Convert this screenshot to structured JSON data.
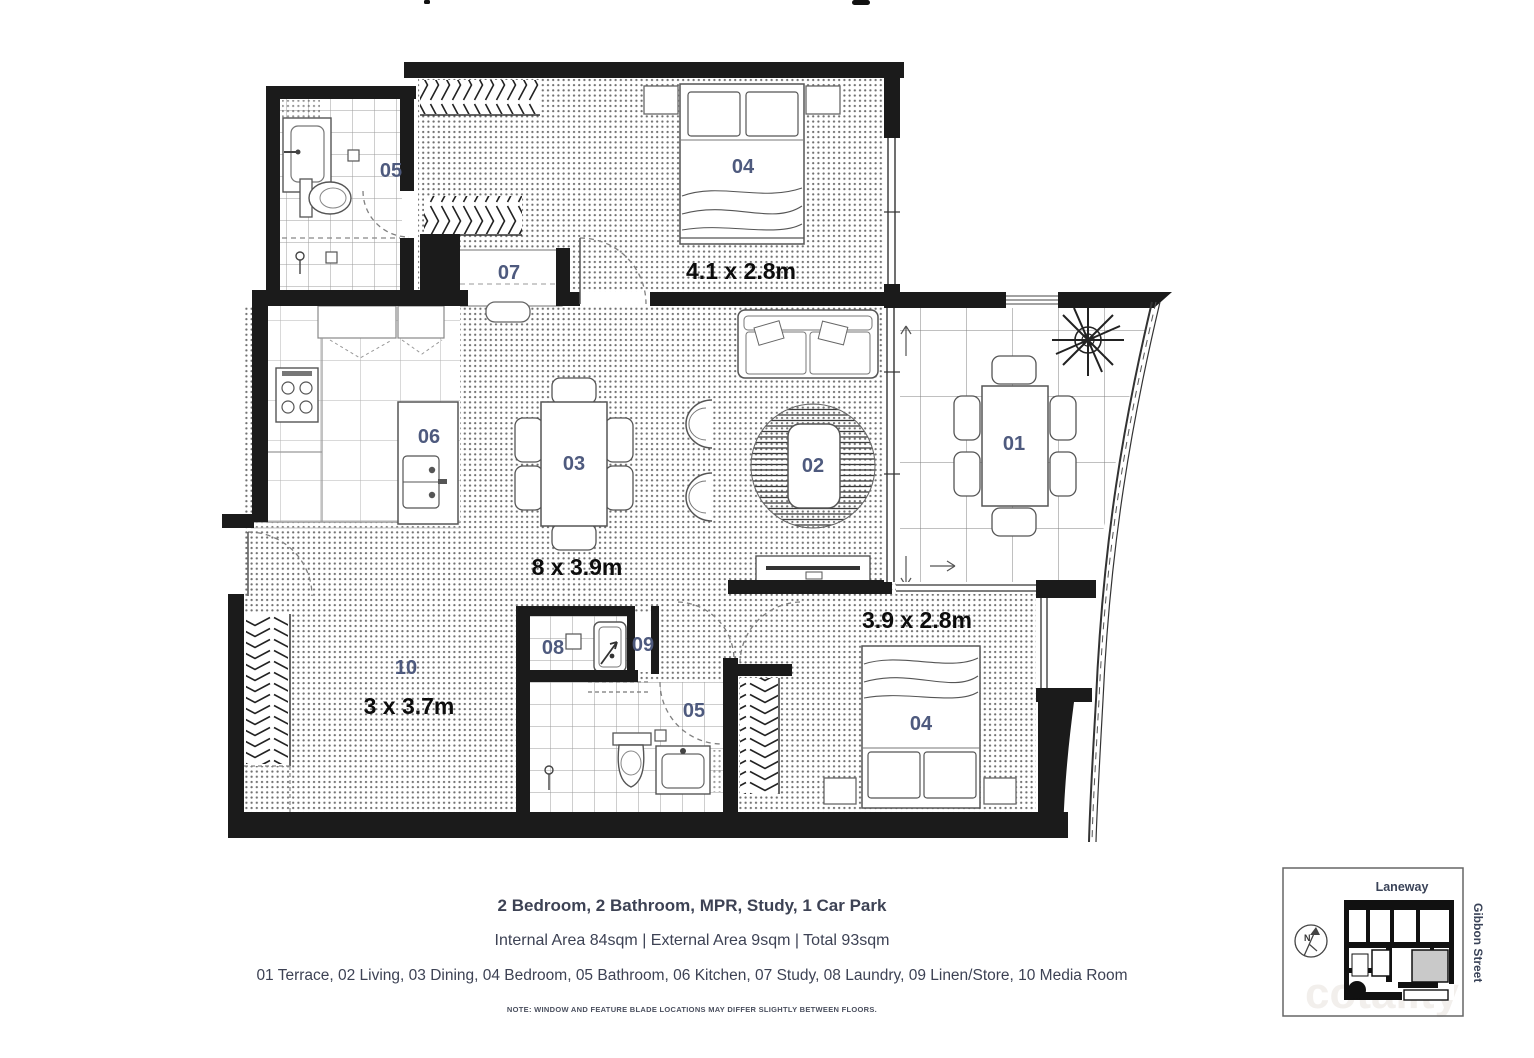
{
  "plan": {
    "labels": {
      "terrace": "01",
      "living": "02",
      "dining": "03",
      "bedroom": "04",
      "bathroom": "05",
      "kitchen": "06",
      "study": "07",
      "laundry": "08",
      "linen": "09",
      "media": "10"
    },
    "dimensions": {
      "bedroom1": "4.1 x 2.8m",
      "living_dining": "8 x 3.9m",
      "bedroom2": "3.9 x 2.8m",
      "media": "3 x 3.7m"
    },
    "colors": {
      "wall": "#1b1b1b",
      "room_label": "#4e5a7e",
      "dimension": "#0d0d0d",
      "footer_text": "#3d4254"
    }
  },
  "footer": {
    "line1": "2 Bedroom, 2 Bathroom, MPR, Study, 1 Car Park",
    "line2": "Internal Area 84sqm  |  External Area 9sqm  |  Total 93sqm",
    "legend": "01 Terrace,  02 Living, 03 Dining, 04 Bedroom, 05 Bathroom, 06 Kitchen, 07 Study, 08 Laundry, 09 Linen/Store, 10 Media Room",
    "note": "NOTE: WINDOW AND FEATURE BLADE LOCATIONS MAY DIFFER SLIGHTLY BETWEEN FLOORS."
  },
  "locator": {
    "laneway_label": "Laneway",
    "street_label": "Gibbon Street",
    "north_label": "N"
  },
  "watermark": {
    "text": "cotality"
  }
}
